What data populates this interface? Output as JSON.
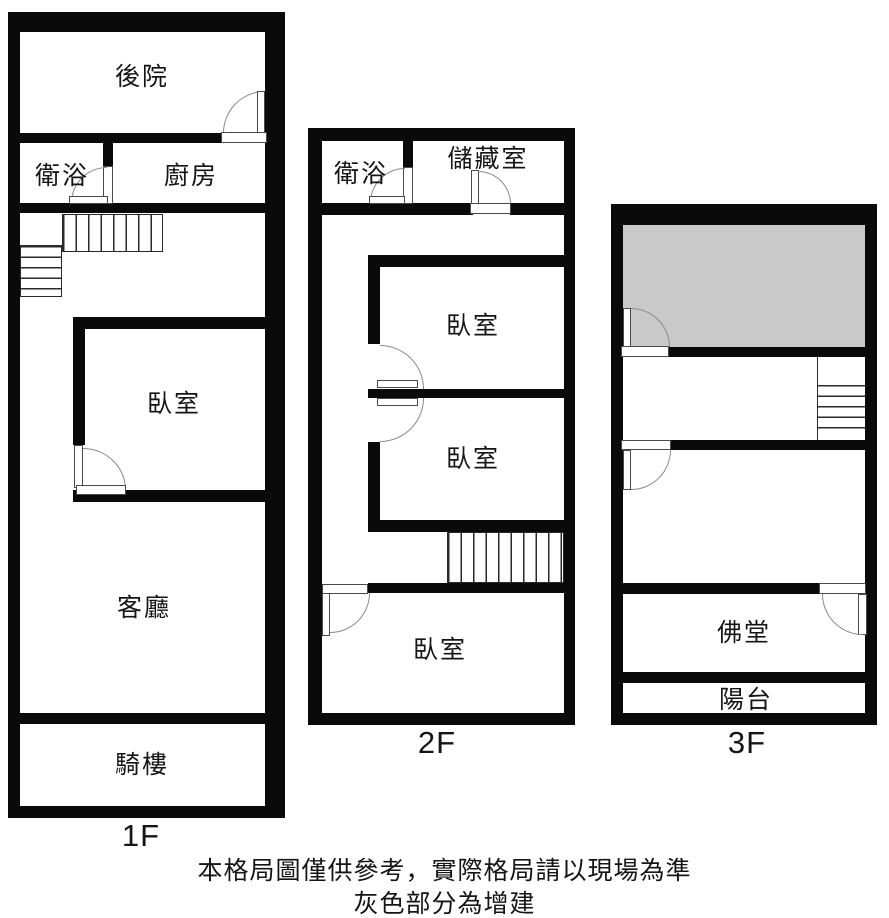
{
  "title": "三層樓透天格局圖",
  "colors": {
    "wall": "#0a0a0a",
    "addition": "#c9c9c9",
    "arc": "#8a8a8a"
  },
  "floors": [
    {
      "label": "1F",
      "rooms": {
        "backyard": "後院",
        "bathroom": "衛浴",
        "kitchen": "廚房",
        "bedroom": "臥室",
        "living_room": "客廳",
        "arcade": "騎樓"
      }
    },
    {
      "label": "2F",
      "rooms": {
        "bathroom": "衛浴",
        "storage": "儲藏室",
        "bedroom_a": "臥室",
        "bedroom_b": "臥室",
        "bedroom_c": "臥室"
      }
    },
    {
      "label": "3F",
      "rooms": {
        "buddhist_hall": "佛堂",
        "balcony": "陽台"
      }
    }
  ],
  "footer": {
    "line1": "本格局圖僅供參考，實際格局請以現場為準",
    "line2": "灰色部分為增建"
  }
}
